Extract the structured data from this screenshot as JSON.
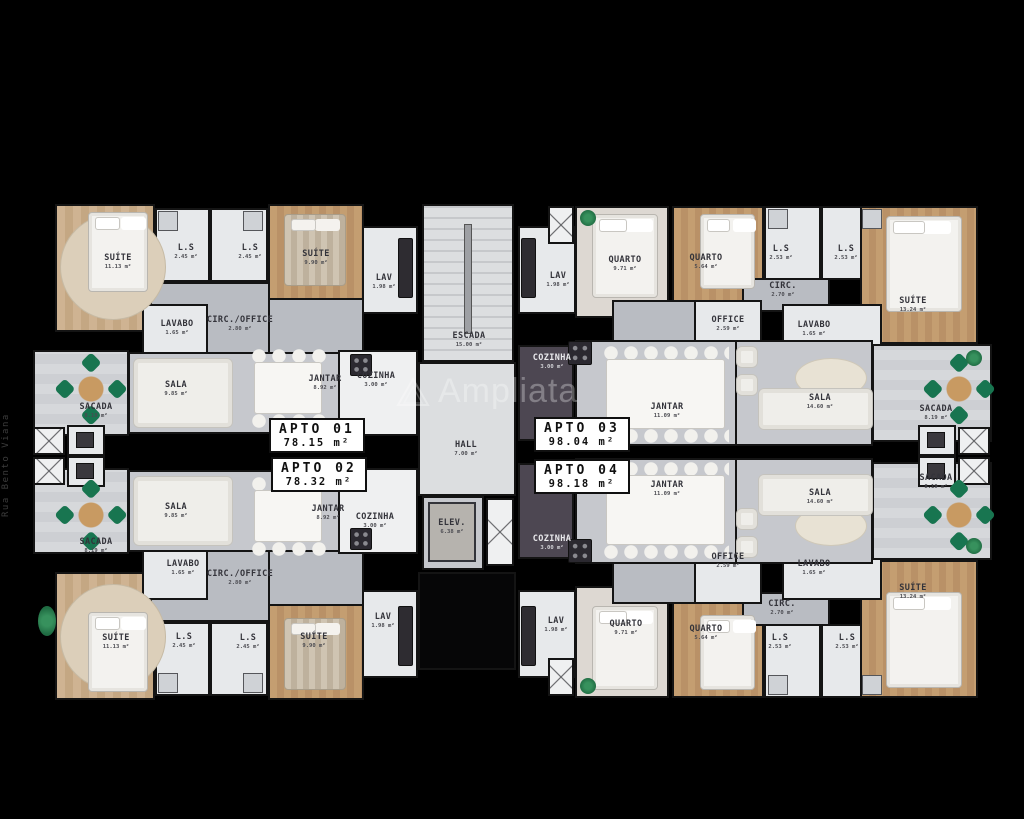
{
  "meta": {
    "watermark": "Ampliata",
    "street_label": "Rua Bento Viana"
  },
  "apartments": [
    {
      "id": "apto-01",
      "label": "APTO 01",
      "area": "78.15 m²"
    },
    {
      "id": "apto-02",
      "label": "APTO 02",
      "area": "78.32 m²"
    },
    {
      "id": "apto-03",
      "label": "APTO 03",
      "area": "98.04 m²"
    },
    {
      "id": "apto-04",
      "label": "APTO 04",
      "area": "98.18 m²"
    }
  ],
  "rooms": [
    {
      "name": "SUÍTE",
      "area": "11.13 m²"
    },
    {
      "name": "L.S",
      "area": "2.45 m²"
    },
    {
      "name": "L.S",
      "area": "2.45 m²"
    },
    {
      "name": "SUÍTE",
      "area": "9.90 m²"
    },
    {
      "name": "LAV",
      "area": "1.98 m²"
    },
    {
      "name": "LAVABO",
      "area": "1.65 m²"
    },
    {
      "name": "CIRC./OFFICE",
      "area": "2.80 m²"
    },
    {
      "name": "SACADA",
      "area": "8.19 m²"
    },
    {
      "name": "SALA",
      "area": "9.85 m²"
    },
    {
      "name": "JANTAR",
      "area": "8.92 m²"
    },
    {
      "name": "COZINHA",
      "area": "3.00 m²"
    },
    {
      "name": "ESCADA",
      "area": "15.00 m²"
    },
    {
      "name": "LAV",
      "area": "1.98 m²"
    },
    {
      "name": "QUARTO",
      "area": "9.71 m²"
    },
    {
      "name": "QUARTO",
      "area": "5.64 m²"
    },
    {
      "name": "L.S",
      "area": "2.53 m²"
    },
    {
      "name": "L.S",
      "area": "2.53 m²"
    },
    {
      "name": "CIRC.",
      "area": "2.70 m²"
    },
    {
      "name": "OFFICE",
      "area": "2.59 m²"
    },
    {
      "name": "LAVABO",
      "area": "1.65 m²"
    },
    {
      "name": "SUÍTE",
      "area": "13.24 m²"
    },
    {
      "name": "COZINHA",
      "area": "3.00 m²"
    },
    {
      "name": "JANTAR",
      "area": "11.09 m²"
    },
    {
      "name": "SALA",
      "area": "14.60 m²"
    },
    {
      "name": "SACADA",
      "area": "8.19 m²"
    },
    {
      "name": "HALL",
      "area": "7.00 m²"
    },
    {
      "name": "ELEV.",
      "area": "6.38 m²"
    },
    {
      "name": "SACADA",
      "area": "8.19 m²"
    },
    {
      "name": "SALA",
      "area": "9.85 m²"
    },
    {
      "name": "JANTAR",
      "area": "8.92 m²"
    },
    {
      "name": "COZINHA",
      "area": "3.00 m²"
    },
    {
      "name": "LAVABO",
      "area": "1.65 m²"
    },
    {
      "name": "CIRC./OFFICE",
      "area": "2.80 m²"
    },
    {
      "name": "SUÍTE",
      "area": "11.13 m²"
    },
    {
      "name": "L.S",
      "area": "2.45 m²"
    },
    {
      "name": "L.S",
      "area": "2.45 m²"
    },
    {
      "name": "SUÍTE",
      "area": "9.90 m²"
    },
    {
      "name": "LAV",
      "area": "1.98 m²"
    },
    {
      "name": "COZINHA",
      "area": "3.00 m²"
    },
    {
      "name": "LAV",
      "area": "1.98 m²"
    },
    {
      "name": "JANTAR",
      "area": "11.09 m²"
    },
    {
      "name": "SALA",
      "area": "14.60 m²"
    },
    {
      "name": "SACADA",
      "area": "8.19 m²"
    },
    {
      "name": "OFFICE",
      "area": "2.59 m²"
    },
    {
      "name": "LAVABO",
      "area": "1.65 m²"
    },
    {
      "name": "CIRC.",
      "area": "2.70 m²"
    },
    {
      "name": "QUARTO",
      "area": "9.71 m²"
    },
    {
      "name": "QUARTO",
      "area": "5.64 m²"
    },
    {
      "name": "L.S",
      "area": "2.53 m²"
    },
    {
      "name": "L.S",
      "area": "2.53 m²"
    },
    {
      "name": "SUÍTE",
      "area": "13.24 m²"
    }
  ]
}
